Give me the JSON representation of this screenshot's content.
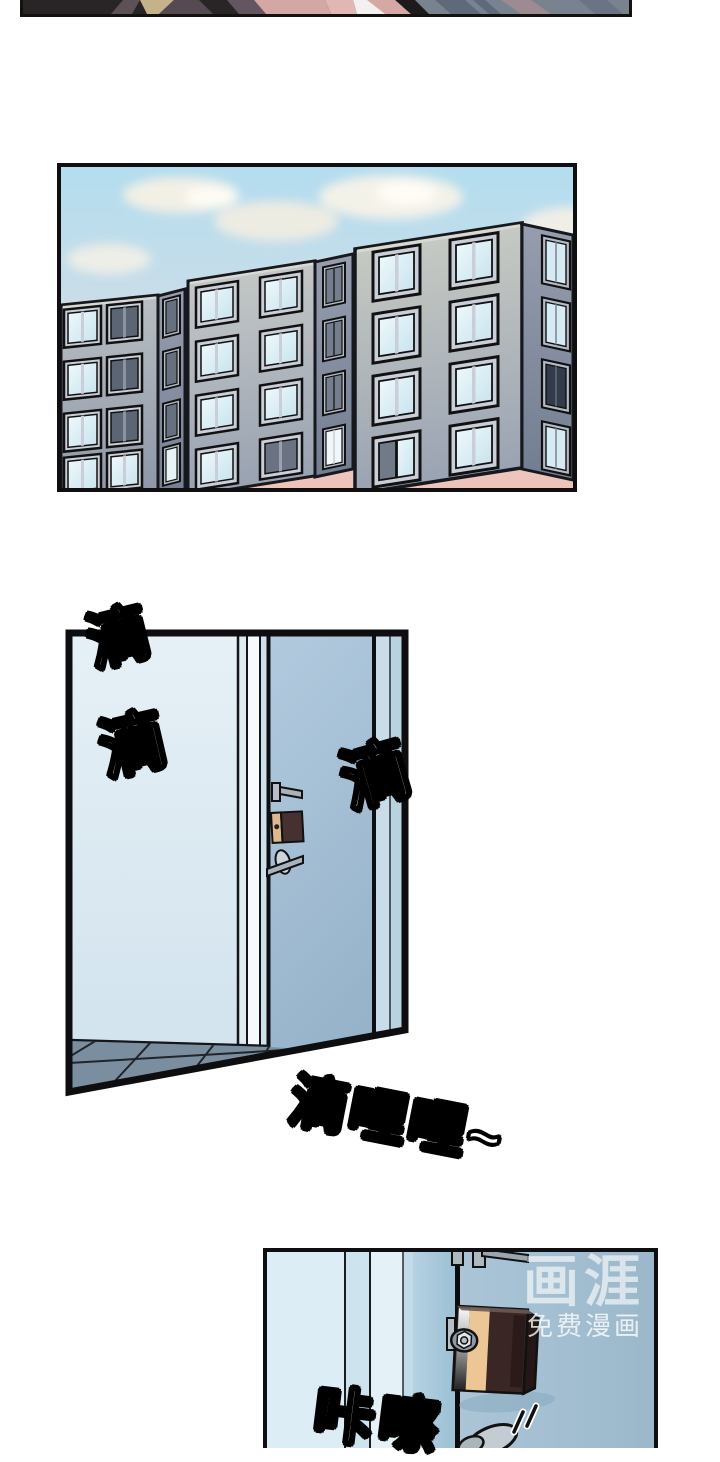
{
  "sfx": {
    "drip_1": "滴",
    "drip_2": "滴",
    "drip_3": "滴",
    "drip_trill": "滴哩哩~",
    "lock_click": "咔嚓"
  },
  "watermark": {
    "brand": "画涯",
    "tagline": "免费漫画"
  },
  "colors": {
    "panel_border": "#0f0f12",
    "sky_top": "#b3ddef",
    "sky_pink": "#eec4ba",
    "cloud": "#f8f2e4",
    "building_front_top": "#c6cac3",
    "building_front_bottom": "#97a0b0",
    "building_side": "#7e8899",
    "window_frame": "#c9ced8",
    "window_glass_light": "#e2f2f8",
    "window_glass_dark": "#5c6573",
    "hall_wall": "#e4eef5",
    "door_face": "#a6c0d4",
    "door_jamb": "#c6dcea",
    "floor_tile": "#7b8ea0",
    "lock_body": "#3a2725",
    "lock_plate_tan": "#e4bd8f",
    "metal_gray": "#b6c0c7",
    "sfx_fill": "#ffffff",
    "sfx_outline": "#000000",
    "watermark_white": "#ffffff"
  }
}
